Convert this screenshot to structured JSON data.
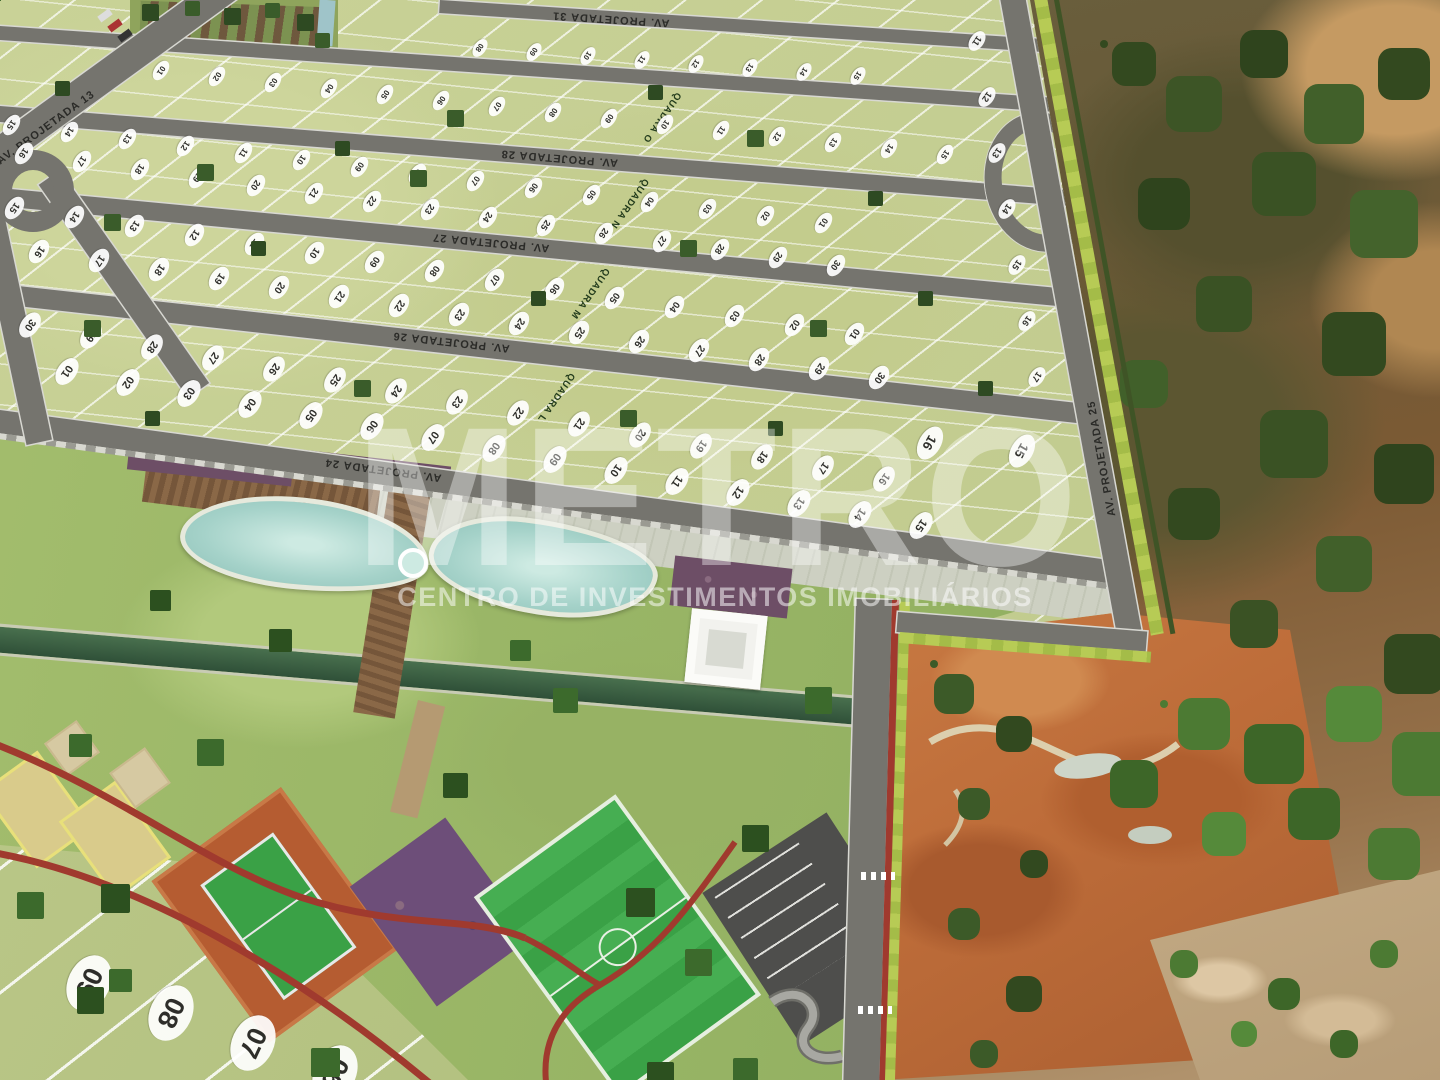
{
  "watermark": {
    "title": "METRO",
    "subtitle": "CENTRO DE INVESTIMENTOS IMOBILIÁRIOS"
  },
  "plat": {
    "streets": {
      "s31": "AV. PROJETADA 31",
      "s28": "AV. PROJETADA 28",
      "s27": "AV. PROJETADA 27",
      "s26": "AV. PROJETADA 26",
      "s24": "AV. PROJETADA 24",
      "s25": "AV. PROJETADA 25",
      "s13": "AV. PROJETADA 13"
    },
    "extra_labels": {
      "s29": "AV. PROJETADA 29"
    },
    "quadras": {
      "qL": "QUADRA L",
      "qM": "QUADRA M",
      "qN": "QUADRA N",
      "qO": "QUADRA O"
    },
    "lot_rows": {
      "r1": [
        "09",
        "08",
        "07",
        "06"
      ],
      "r2": [
        "01",
        "02",
        "03",
        "04",
        "05",
        "06",
        "07",
        "08",
        "09",
        "10",
        "11",
        "12",
        "13",
        "14",
        "15"
      ],
      "r3": [
        "30",
        "29",
        "28",
        "27",
        "26",
        "25",
        "24",
        "23",
        "22",
        "21",
        "20",
        "19",
        "18",
        "17",
        "16"
      ],
      "r4": [
        "16",
        "17",
        "18",
        "19",
        "20",
        "21",
        "22",
        "23",
        "24",
        "25",
        "26",
        "27",
        "28",
        "29",
        "30"
      ],
      "r5": [
        "15",
        "14",
        "13",
        "12",
        "11",
        "10",
        "09",
        "08",
        "07",
        "06",
        "05",
        "04",
        "03",
        "02",
        "01"
      ],
      "r6": [
        "16",
        "17",
        "18",
        "19",
        "20",
        "21",
        "22",
        "23",
        "24",
        "25",
        "26",
        "27",
        "28",
        "29",
        "30"
      ],
      "r7": [
        "15",
        "14",
        "13",
        "12",
        "11",
        "10",
        "09",
        "08",
        "07",
        "06",
        "05",
        "04",
        "03",
        "02",
        "01"
      ],
      "r8": [
        "01",
        "02",
        "03",
        "04",
        "05",
        "06",
        "07",
        "08",
        "09",
        "10",
        "11",
        "12",
        "13",
        "14",
        "15"
      ],
      "r9": [
        "08",
        "09",
        "10",
        "11",
        "12",
        "13",
        "14",
        "15"
      ],
      "r10": [
        "11",
        "12",
        "13",
        "14",
        "15",
        "16",
        "17"
      ],
      "r11": [
        "16",
        "15"
      ]
    }
  },
  "palette": {
    "street": "#75746e",
    "lot-green": "#c9d297",
    "lawn-green": "#9cb96b",
    "dirt-orange": "#bd6c39",
    "pool-blue": "#a5d2c9",
    "track-red": "#a03a2e",
    "court-green": "#3aa146",
    "clay-orange": "#b55c31",
    "hedge-green": "#b7cb55",
    "watermark-white": "rgba(255,255,255,0.38)"
  }
}
